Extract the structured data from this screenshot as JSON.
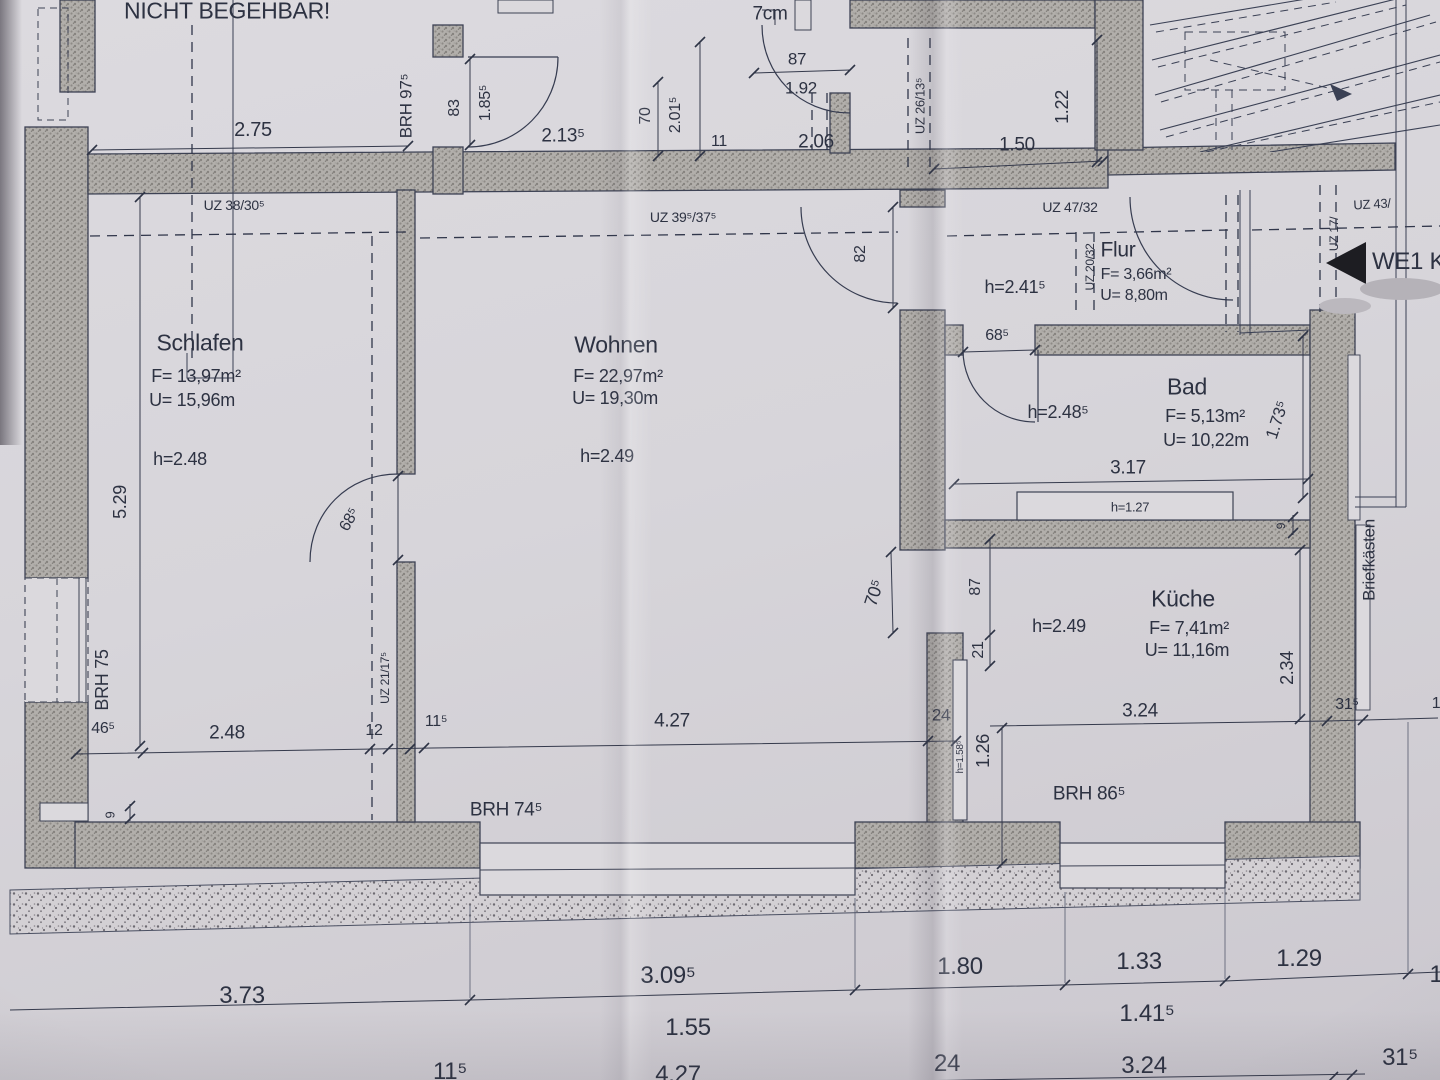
{
  "rooms": {
    "schlafen": {
      "name": "Schlafen",
      "area": "F= 13,97m²",
      "perimeter": "U= 15,96m",
      "height": "h=2.48"
    },
    "wohnen": {
      "name": "Wohnen",
      "area": "F= 22,97m²",
      "perimeter": "U= 19,30m",
      "height": "h=2.49"
    },
    "flur": {
      "name": "Flur",
      "area": "F= 3,66m²",
      "perimeter": "U= 8,80m",
      "height": "h=2.41⁵"
    },
    "bad": {
      "name": "Bad",
      "area": "F= 5,13m²",
      "perimeter": "U= 10,22m",
      "height": "h=2.48⁵"
    },
    "kueche": {
      "name": "Küche",
      "area": "F= 7,41m²",
      "perimeter": "U= 11,16m",
      "height": "h=2.49"
    }
  },
  "annotations": {
    "nicht_begehbar": "NICHT BEGEHBAR!",
    "stufenhoehe": "Stufenhöhe",
    "stufenhoehe_value": "7cm",
    "we1": "WE1 Kus",
    "briefkaesten": "Briefkästen",
    "h_1_27": "h=1.27",
    "h_1_58_5": "h=1.58⁵"
  },
  "beams": {
    "uz_38_30_5": "UZ 38/30⁵",
    "uz_39_5_37_5": "UZ 39⁵/37⁵",
    "uz_47_32": "UZ 47/32",
    "uz_43": "UZ 43/",
    "uz_17": "UZ 17/",
    "uz_20_32": "UZ 20/32",
    "uz_26_13_5": "UZ 26/13⁵",
    "uz_21_17_5": "UZ 21/17⁵"
  },
  "dimensions": {
    "top": {
      "d_2_75": "2.75",
      "brh_97_5": "BRH 97⁵",
      "d_83": "83",
      "d_1_85_5": "1.85⁵",
      "d_2_13_5": "2.13⁵",
      "d_70": "70",
      "d_2_01_5": "2.01⁵",
      "d_11": "11",
      "d_87": "87",
      "d_1_92": "1.92",
      "d_2_06": "2.06",
      "d_1_22": "1.22",
      "d_1_50": "1.50"
    },
    "middle": {
      "d_82": "82",
      "d_68_5_flur": "68⁵",
      "d_3_17": "3.17",
      "d_1_73_5": "1.73⁵",
      "d_9_bad": "9",
      "d_68_5_schlafen": "68⁵",
      "d_5_29": "5.29",
      "d_70_5": "70⁵",
      "d_87_kueche": "87",
      "d_21": "21",
      "d_2_34": "2.34"
    },
    "lower": {
      "brh_75": "BRH 75",
      "d_46_5": "46⁵",
      "d_2_48": "2.48",
      "d_12": "12",
      "d_11_5": "11⁵",
      "d_4_27": "4.27",
      "d_24": "24",
      "d_1_26": "1.26",
      "d_3_24": "3.24",
      "d_31_5": "31⁵",
      "d_9": "9",
      "brh_74_5": "BRH 74⁵",
      "brh_86_5": "BRH 86⁵",
      "d_1_partial": "1"
    },
    "bottom": {
      "d_3_73": "3.73",
      "d_3_09_5": "3.09⁵",
      "d_1_55": "1.55",
      "d_1_80": "1.80",
      "d_1_33": "1.33",
      "d_1_41_5": "1.41⁵",
      "d_1_29": "1.29",
      "d_1_partial": "1",
      "b_11_5": "11⁵",
      "b_4_27": "4.27",
      "b_24": "24",
      "b_3_24": "3.24",
      "b_31_5": "31⁵"
    }
  }
}
